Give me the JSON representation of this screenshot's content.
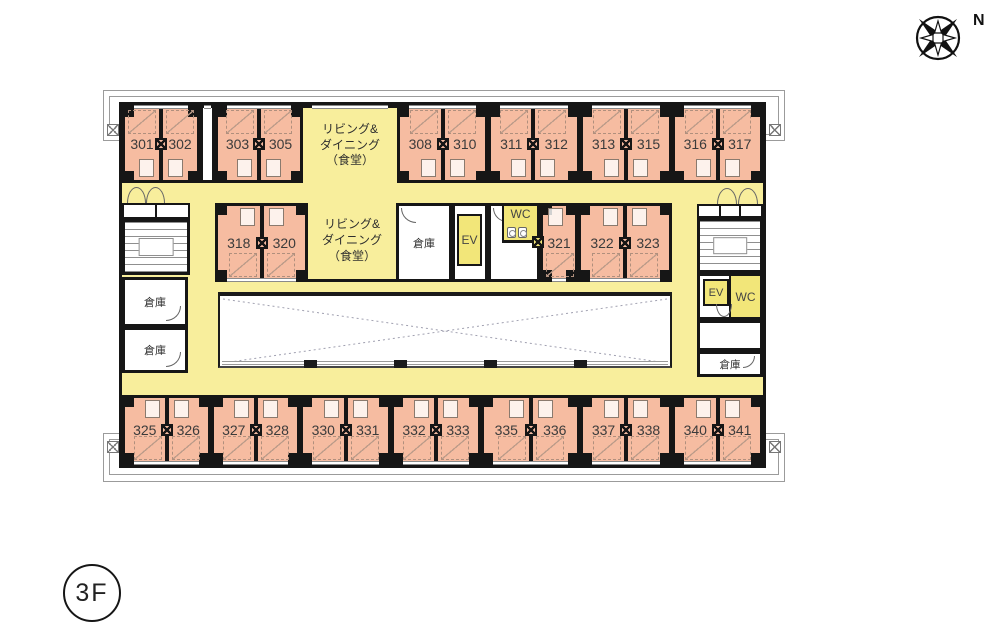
{
  "floor_label": "3F",
  "compass_label": "N",
  "living": {
    "l1": "リビング&",
    "l2": "ダイニング",
    "l3": "（食堂）"
  },
  "labels": {
    "storage": "倉庫",
    "elevator": "EV",
    "toilet": "WC"
  },
  "single_room": "321",
  "pairs": {
    "t1": {
      "a": "301",
      "b": "302"
    },
    "t2": {
      "a": "303",
      "b": "305"
    },
    "t3": {
      "a": "308",
      "b": "310"
    },
    "t4": {
      "a": "311",
      "b": "312"
    },
    "t5": {
      "a": "313",
      "b": "315"
    },
    "t6": {
      "a": "316",
      "b": "317"
    },
    "m1": {
      "a": "318",
      "b": "320"
    },
    "m2": {
      "a": "322",
      "b": "323"
    },
    "b1": {
      "a": "325",
      "b": "326"
    },
    "b2": {
      "a": "327",
      "b": "328"
    },
    "b3": {
      "a": "330",
      "b": "331"
    },
    "b4": {
      "a": "332",
      "b": "333"
    },
    "b5": {
      "a": "335",
      "b": "336"
    },
    "b6": {
      "a": "337",
      "b": "338"
    },
    "b7": {
      "a": "340",
      "b": "341"
    }
  },
  "colors": {
    "room_fill": "#f6bca1",
    "corridor_fill": "#f8ee9c",
    "service_fill": "#f2e679",
    "wall": "#161616"
  }
}
